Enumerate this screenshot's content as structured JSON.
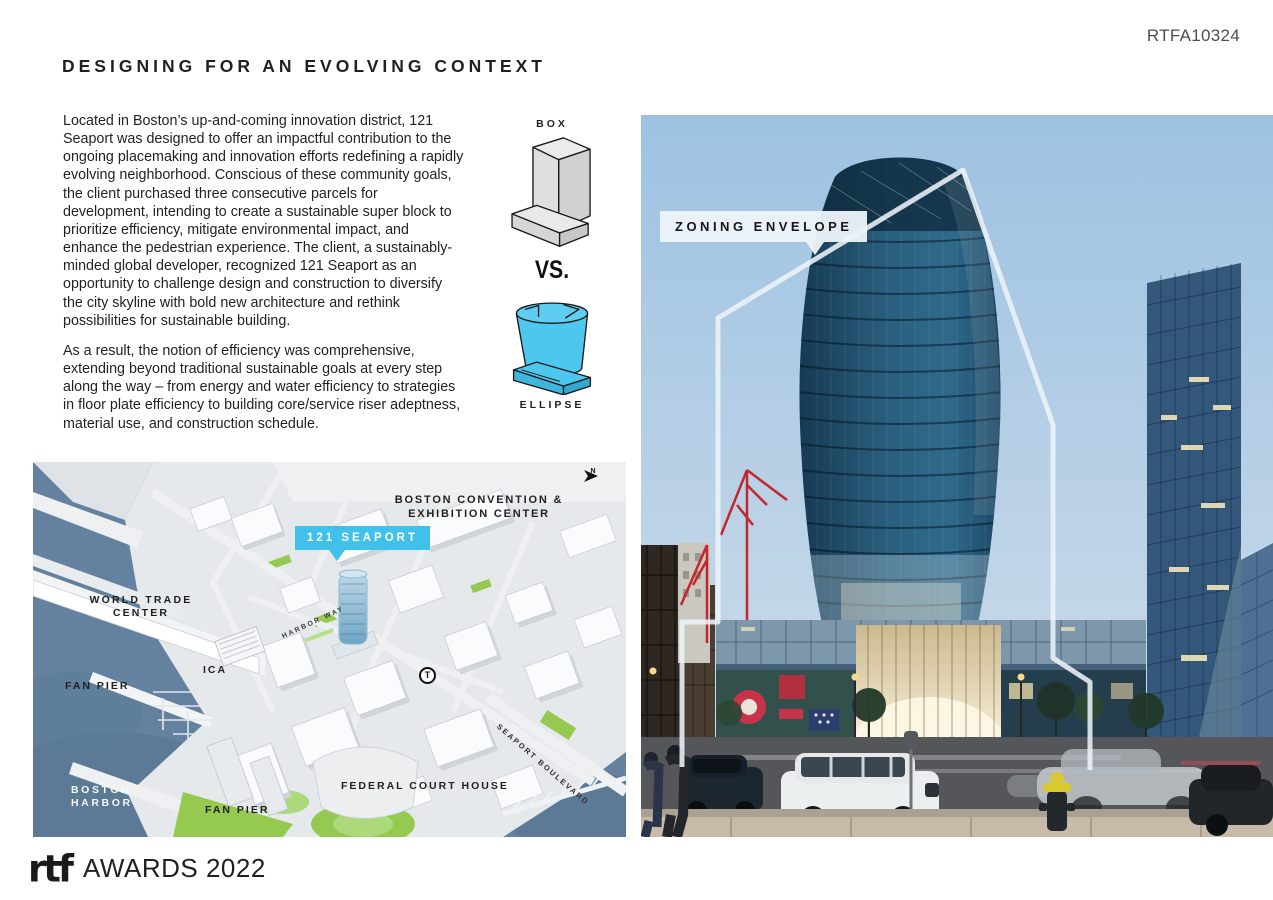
{
  "page": {
    "ref_code": "RTFA10324",
    "title": "DESIGNING FOR AN EVOLVING CONTEXT"
  },
  "article": {
    "paragraph1": "Located in Boston’s up-and-coming innovation district, 121 Seaport was designed to offer an impactful contribution to the ongoing placemaking and innovation efforts redefining a rapidly evolving neighborhood. Conscious of these community goals, the client purchased three consecutive parcels for development, intending to create a sustainable super block to prioritize efficiency, mitigate environmental impact, and enhance the pedestrian experience. The client, a sustainably-minded global developer, recognized 121 Seaport as an opportunity to challenge design and construction to diversify the city skyline with bold new architecture and rethink possibilities for sustainable building.",
    "paragraph2": "As a result, the notion of efficiency was comprehensive, extending beyond traditional sustainable goals at every step along the way – from energy and water efficiency to strategies in floor plate efficiency to building core/service riser adeptness, material use, and construction schedule."
  },
  "diagram": {
    "box_label": "BOX",
    "versus_label": "VS.",
    "ellipse_label": "ELLIPSE",
    "box_color": "#D9DADB",
    "ellipse_color": "#4EC7EE"
  },
  "photo": {
    "callout_label": "ZONING ENVELOPE",
    "envelope_color": "#EDF3F8"
  },
  "map": {
    "badge_label": "121 SEAPORT",
    "north_label": "N",
    "labels": {
      "convention_line1": "BOSTON CONVENTION &",
      "convention_line2": "EXHIBITION CENTER",
      "world_trade_line1": "WORLD TRADE",
      "world_trade_line2": "CENTER",
      "ica": "ICA",
      "fan_pier_upper": "FAN PIER",
      "boston_harbor_line1": "BOSTON",
      "boston_harbor_line2": "HARBOR",
      "fan_pier_lower": "FAN PIER",
      "federal_court_house": "FEDERAL COURT HOUSE",
      "seaport_boulevard": "SEAPORT BOULEVARD",
      "harbor_way": "HARBOR WAY",
      "transit": "T"
    }
  },
  "colors": {
    "accent_cyan": "#41C0E9",
    "map_water": "#64829F",
    "park_green": "#8CC63F",
    "sky_blue": "#A6C8E4",
    "envelope_line": "#EDF3F8",
    "ink": "#231F20"
  },
  "footer": {
    "logo_text": "rtf",
    "awards_text": "AWARDS 2022"
  }
}
